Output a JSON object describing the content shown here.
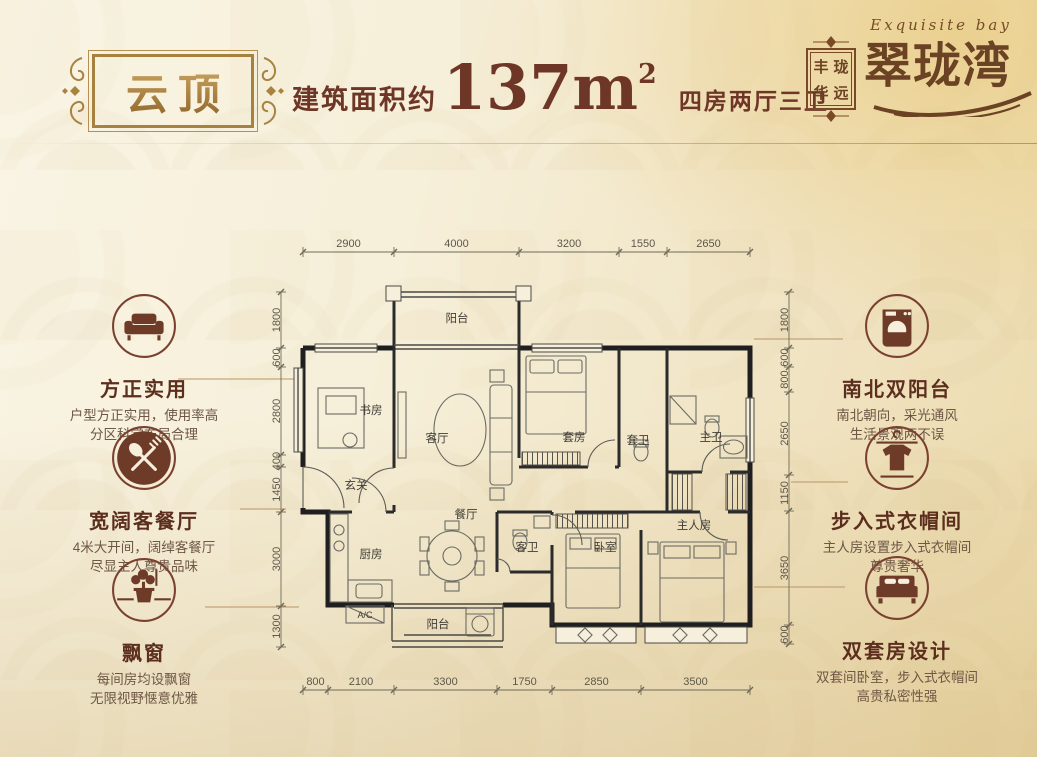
{
  "colors": {
    "accent_brown": "#6e3626",
    "gold": "#a9823f",
    "logo_brown": "#6b4223",
    "background_cream": "#f4ecd5"
  },
  "plate": {
    "title": "云顶"
  },
  "headline": {
    "prefix": "建筑面积约",
    "area": "137m",
    "area_sup": "2",
    "rooms": "四房两厅三卫"
  },
  "logo": {
    "english": "Exquisite bay",
    "brand": "翠珑湾",
    "seal": [
      "丰",
      "珑",
      "华",
      "远"
    ]
  },
  "features_left": [
    {
      "icon": "sofa",
      "title": "方正实用",
      "line1": "户型方正实用，使用率高",
      "line2": "分区科学布局合理"
    },
    {
      "icon": "cutlery",
      "title": "宽阔客餐厅",
      "line1": "4米大开间，阔绰客餐厅",
      "line2": "尽显主人尊贵品味"
    },
    {
      "icon": "bonsai",
      "title": "飘窗",
      "line1": "每间房均设飘窗",
      "line2": "无限视野惬意优雅"
    }
  ],
  "features_right": [
    {
      "icon": "washing-machine",
      "title": "南北双阳台",
      "line1": "南北朝向，采光通风",
      "line2": "生活景观两不误"
    },
    {
      "icon": "sweater",
      "title": "步入式衣帽间",
      "line1": "主人房设置步入式衣帽间",
      "line2": "尊贵奢华"
    },
    {
      "icon": "double-bed",
      "title": "双套房设计",
      "line1": "双套间卧室，步入式衣帽间",
      "line2": "高贵私密性强"
    }
  ],
  "floorplan": {
    "rooms": [
      {
        "label": "阳台",
        "x": 457,
        "y": 322
      },
      {
        "label": "书房",
        "x": 371,
        "y": 414
      },
      {
        "label": "客厅",
        "x": 437,
        "y": 442
      },
      {
        "label": "套房",
        "x": 574,
        "y": 441
      },
      {
        "label": "套卫",
        "x": 638,
        "y": 444
      },
      {
        "label": "主卫",
        "x": 711,
        "y": 441
      },
      {
        "label": "玄关",
        "x": 356,
        "y": 489
      },
      {
        "label": "餐厅",
        "x": 466,
        "y": 518
      },
      {
        "label": "厨房",
        "x": 371,
        "y": 558
      },
      {
        "label": "客卫",
        "x": 527,
        "y": 551
      },
      {
        "label": "卧室",
        "x": 605,
        "y": 551
      },
      {
        "label": "主人房",
        "x": 694,
        "y": 529
      },
      {
        "label": "阳台",
        "x": 438,
        "y": 628
      },
      {
        "label": "A/C",
        "x": 365,
        "y": 618,
        "small": true
      }
    ],
    "dims": {
      "top": {
        "y": 252,
        "ticks": [
          303,
          394,
          519,
          619,
          667,
          750
        ],
        "labels": [
          "2900",
          "4000",
          "3200",
          "1550",
          "2650"
        ]
      },
      "bottom": {
        "y": 690,
        "ticks": [
          303,
          328,
          394,
          497,
          552,
          641,
          750
        ],
        "labels": [
          "800",
          "2100",
          "3300",
          "1750",
          "2850",
          "3500"
        ]
      },
      "left": {
        "x": 281,
        "ticks": [
          292,
          348,
          367,
          455,
          467,
          512,
          606,
          647
        ],
        "labels": [
          "1800",
          "600",
          "2800",
          "400",
          "1450",
          "3000",
          "1300"
        ]
      },
      "right": {
        "x": 789,
        "ticks": [
          292,
          348,
          367,
          392,
          475,
          511,
          625,
          644
        ],
        "labels": [
          "1800",
          "600",
          "800",
          "2650",
          "1150",
          "3650",
          "600"
        ]
      }
    },
    "leader_lines": [
      {
        "x1": 178,
        "y1": 379,
        "x2": 299,
        "y2": 379
      },
      {
        "x1": 240,
        "y1": 509,
        "x2": 286,
        "y2": 509
      },
      {
        "x1": 205,
        "y1": 607,
        "x2": 299,
        "y2": 607
      },
      {
        "x1": 754,
        "y1": 339,
        "x2": 843,
        "y2": 339
      },
      {
        "x1": 791,
        "y1": 482,
        "x2": 848,
        "y2": 482
      },
      {
        "x1": 754,
        "y1": 587,
        "x2": 845,
        "y2": 587
      }
    ]
  }
}
